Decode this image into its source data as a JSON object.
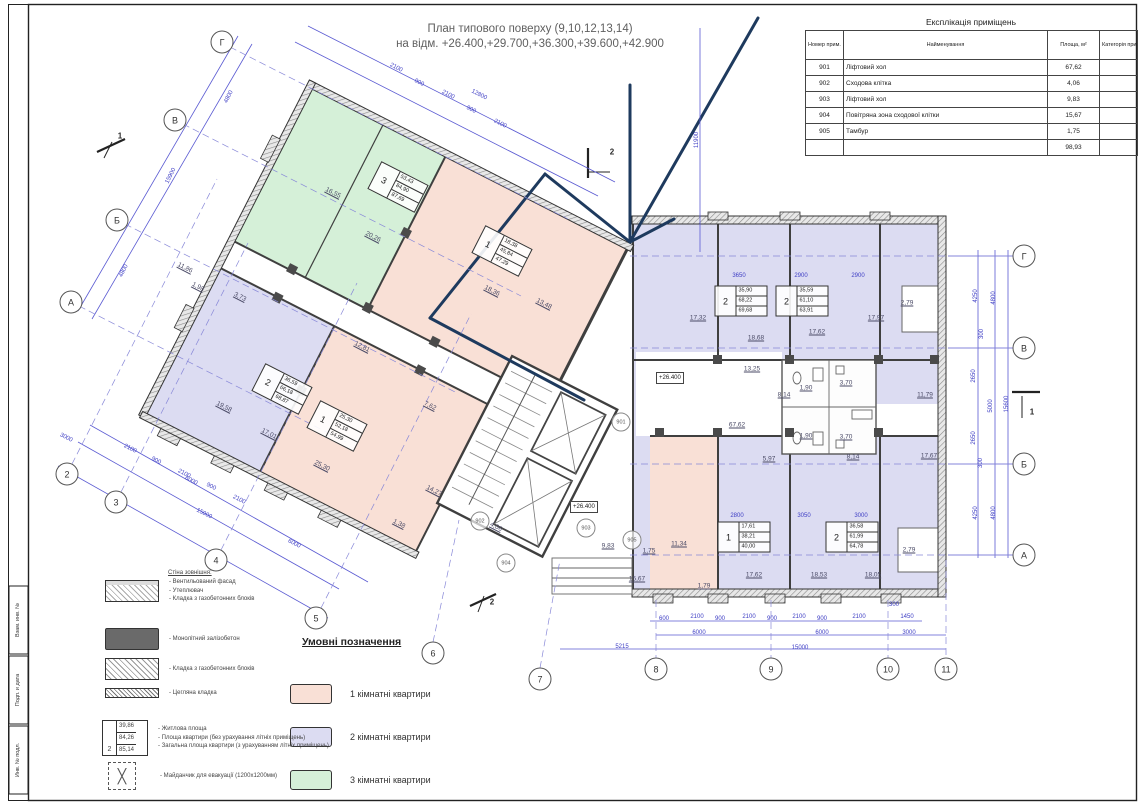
{
  "page": {
    "title1": "План типового поверху (9,10,12,13,14)",
    "title2": "на відм. +26.400,+29.700,+36.300,+39.600,+42.900"
  },
  "stamp": [
    "Взам. инв. №",
    "Подп. и дата",
    "Инв. № подл."
  ],
  "explication": {
    "title": "Експлікація приміщень",
    "col_num": "Номер прим.",
    "col_name": "Найменування",
    "col_area": "Площа, м²",
    "col_cat": "Категорія прим.",
    "rows": [
      [
        "901",
        "Ліфтовий хол",
        "67,62"
      ],
      [
        "902",
        "Сходова клітка",
        "4,06"
      ],
      [
        "903",
        "Ліфтовий хол",
        "9,83"
      ],
      [
        "904",
        "Повітряна зона сходової клітки",
        "15,67"
      ],
      [
        "905",
        "Тамбур",
        "1,75"
      ]
    ],
    "total": "98,93"
  },
  "legend": {
    "title": "Умовні позначення",
    "items": [
      {
        "color": "#f9e0d6",
        "label": "1 кімнатні квартири"
      },
      {
        "color": "#dcdcf2",
        "label": "2 кімнатні квартири"
      },
      {
        "color": "#d5f0d8",
        "label": "3 кімнатні квартири"
      },
      {
        "color": "#ffffff",
        "label": "приміщення загального користування"
      }
    ]
  },
  "wall_legend": {
    "title": "Стіна зовнішня:",
    "items": [
      {
        "swatch": "facade",
        "lines": [
          "- Вентильований фасад",
          "- Утеплювач",
          "- Кладка з газобетонних блоків"
        ]
      },
      {
        "swatch": "concrete",
        "lines": [
          "- Монолітний залізобетон"
        ]
      },
      {
        "swatch": "blocks",
        "lines": [
          "- Кладка з газобетонних блоків"
        ]
      },
      {
        "swatch": "brick",
        "lines": [
          "- Цегляна кладка"
        ]
      }
    ],
    "area_sample": {
      "type": "2",
      "values": [
        "39,86",
        "84,26",
        "85,14"
      ],
      "lines": [
        "- Житлова площа",
        "- Площа квартири (без урахування літніх приміщень)",
        "- Загальна площа квартири (з урахуванням літніх приміщень)"
      ]
    },
    "evac_label": "- Майданчик для евакуації (1200х1200мм)"
  },
  "apartments": [
    {
      "type": "3",
      "values": [
        "53,43",
        "84,90",
        "87,69"
      ],
      "x": 398,
      "y": 187,
      "rot": 27
    },
    {
      "type": "1",
      "values": [
        "18,38",
        "45,84",
        "47,29"
      ],
      "x": 502,
      "y": 251,
      "rot": 27
    },
    {
      "type": "2",
      "values": [
        "36,59",
        "66,18",
        "68,87"
      ],
      "x": 282,
      "y": 389,
      "rot": 27
    },
    {
      "type": "1",
      "values": [
        "25,30",
        "52,18",
        "54,99"
      ],
      "x": 337,
      "y": 426,
      "rot": 27
    },
    {
      "type": "2",
      "values": [
        "35,90",
        "68,22",
        "69,68"
      ],
      "x": 741,
      "y": 301,
      "rot": 0
    },
    {
      "type": "2",
      "values": [
        "35,59",
        "61,10",
        "63,91"
      ],
      "x": 802,
      "y": 301,
      "rot": 0
    },
    {
      "type": "1",
      "values": [
        "17,61",
        "38,21",
        "40,00"
      ],
      "x": 744,
      "y": 537,
      "rot": 0
    },
    {
      "type": "2",
      "values": [
        "36,58",
        "61,99",
        "64,78"
      ],
      "x": 852,
      "y": 537,
      "rot": 0
    }
  ],
  "room_labels": [
    [
      "16,55",
      333,
      193,
      27
    ],
    [
      "20,26",
      373,
      237,
      27
    ],
    [
      "18,36",
      492,
      291,
      27
    ],
    [
      "13,48",
      544,
      304,
      27
    ],
    [
      "11,86",
      185,
      268,
      27
    ],
    [
      "1,98",
      198,
      287,
      27
    ],
    [
      "3,73",
      240,
      297,
      27
    ],
    [
      "12,81",
      362,
      347,
      27
    ],
    [
      "19,58",
      224,
      407,
      27
    ],
    [
      "17,01",
      269,
      434,
      27
    ],
    [
      "25,30",
      322,
      466,
      27
    ],
    [
      "7,62",
      430,
      406,
      27
    ],
    [
      "14,27",
      434,
      491,
      27
    ],
    [
      "1,38",
      399,
      524,
      27
    ],
    [
      "4,06",
      496,
      527,
      27
    ],
    [
      "9,83",
      608,
      546,
      0
    ],
    [
      "1,75",
      649,
      551,
      0
    ],
    [
      "15,67",
      637,
      579,
      0
    ],
    [
      "67,62",
      737,
      425,
      0
    ],
    [
      "17,32",
      698,
      318,
      0
    ],
    [
      "18,68",
      756,
      338,
      0
    ],
    [
      "17,62",
      817,
      332,
      0
    ],
    [
      "17,97",
      876,
      318,
      0
    ],
    [
      "2,79",
      907,
      303,
      0
    ],
    [
      "13,25",
      752,
      369,
      0
    ],
    [
      "8,14",
      784,
      395,
      0
    ],
    [
      "8,14",
      853,
      457,
      0
    ],
    [
      "1,90",
      806,
      388,
      0
    ],
    [
      "1,90",
      806,
      436,
      0
    ],
    [
      "3,70",
      846,
      383,
      0
    ],
    [
      "3,70",
      846,
      437,
      0
    ],
    [
      "11,79",
      925,
      395,
      0
    ],
    [
      "17,67",
      929,
      456,
      0
    ],
    [
      "5,97",
      769,
      459,
      0
    ],
    [
      "11,34",
      679,
      544,
      0
    ],
    [
      "17,62",
      754,
      575,
      0
    ],
    [
      "18,53",
      819,
      575,
      0
    ],
    [
      "18,05",
      873,
      575,
      0
    ],
    [
      "2,79",
      909,
      550,
      0
    ],
    [
      "1,79",
      704,
      586,
      0
    ]
  ],
  "dim_labels": [
    [
      "4250",
      976,
      296,
      -90
    ],
    [
      "4800",
      994,
      298,
      -90
    ],
    [
      "300",
      982,
      334,
      -90
    ],
    [
      "2650",
      974,
      376,
      -90
    ],
    [
      "5000",
      991,
      406,
      -90
    ],
    [
      "2650",
      974,
      438,
      -90
    ],
    [
      "300",
      981,
      463,
      -90
    ],
    [
      "4250",
      976,
      513,
      -90
    ],
    [
      "4800",
      994,
      513,
      -90
    ],
    [
      "15600",
      1007,
      404,
      -90
    ],
    [
      "600",
      664,
      619,
      0
    ],
    [
      "2100",
      697,
      617,
      0
    ],
    [
      "900",
      720,
      619,
      0
    ],
    [
      "2100",
      749,
      617,
      0
    ],
    [
      "900",
      772,
      619,
      0
    ],
    [
      "2100",
      799,
      617,
      0
    ],
    [
      "900",
      822,
      619,
      0
    ],
    [
      "2100",
      859,
      617,
      0
    ],
    [
      "300",
      894,
      605,
      0
    ],
    [
      "1450",
      907,
      617,
      0
    ],
    [
      "6000",
      699,
      633,
      0
    ],
    [
      "6000",
      822,
      633,
      0
    ],
    [
      "3000",
      909,
      633,
      0
    ],
    [
      "15000",
      800,
      648,
      0
    ],
    [
      "5215",
      622,
      647,
      0
    ],
    [
      "3650",
      739,
      276,
      0
    ],
    [
      "2900",
      801,
      276,
      0
    ],
    [
      "2900",
      858,
      276,
      0
    ],
    [
      "2800",
      737,
      516,
      0
    ],
    [
      "3050",
      804,
      516,
      0
    ],
    [
      "3000",
      861,
      516,
      0
    ],
    [
      "11900",
      697,
      140,
      -90
    ],
    [
      "12800",
      479,
      95,
      27
    ],
    [
      "2100",
      396,
      68,
      27
    ],
    [
      "900",
      419,
      83,
      27
    ],
    [
      "2100",
      448,
      95,
      27
    ],
    [
      "900",
      471,
      110,
      27
    ],
    [
      "2100",
      500,
      124,
      27
    ],
    [
      "3000",
      66,
      438,
      27
    ],
    [
      "2100",
      130,
      449,
      27
    ],
    [
      "900",
      156,
      461,
      27
    ],
    [
      "2100",
      184,
      474,
      27
    ],
    [
      "900",
      211,
      487,
      27
    ],
    [
      "2100",
      239,
      500,
      27
    ],
    [
      "6000",
      191,
      481,
      27
    ],
    [
      "15000",
      204,
      514,
      27
    ],
    [
      "6000",
      294,
      544,
      27
    ],
    [
      "4800",
      229,
      97,
      -63
    ],
    [
      "15900",
      171,
      176,
      -63
    ],
    [
      "4800",
      124,
      271,
      -63
    ]
  ],
  "sections": [
    [
      "1",
      120,
      136
    ],
    [
      "2",
      612,
      152
    ],
    [
      "1",
      1032,
      412
    ],
    [
      "2",
      492,
      602
    ]
  ],
  "axes": [
    [
      "Г",
      222,
      42
    ],
    [
      "В",
      175,
      120
    ],
    [
      "Б",
      117,
      220
    ],
    [
      "А",
      71,
      302
    ],
    [
      "2",
      67,
      474
    ],
    [
      "3",
      116,
      502
    ],
    [
      "4",
      216,
      560
    ],
    [
      "5",
      316,
      618
    ],
    [
      "6",
      433,
      653
    ],
    [
      "7",
      540,
      679
    ],
    [
      "8",
      656,
      669
    ],
    [
      "9",
      771,
      669
    ],
    [
      "10",
      888,
      669
    ],
    [
      "11",
      946,
      669
    ],
    [
      "Г",
      1024,
      256
    ],
    [
      "В",
      1024,
      348
    ],
    [
      "Б",
      1024,
      464
    ],
    [
      "А",
      1024,
      555
    ]
  ],
  "room_bubbles": [
    [
      "901",
      621,
      422
    ],
    [
      "902",
      480,
      521
    ],
    [
      "903",
      586,
      528
    ],
    [
      "904",
      506,
      563
    ],
    [
      "905",
      632,
      540
    ]
  ],
  "elevations": [
    [
      "+26.400",
      656,
      372
    ],
    [
      "+26.400",
      570,
      501
    ]
  ]
}
